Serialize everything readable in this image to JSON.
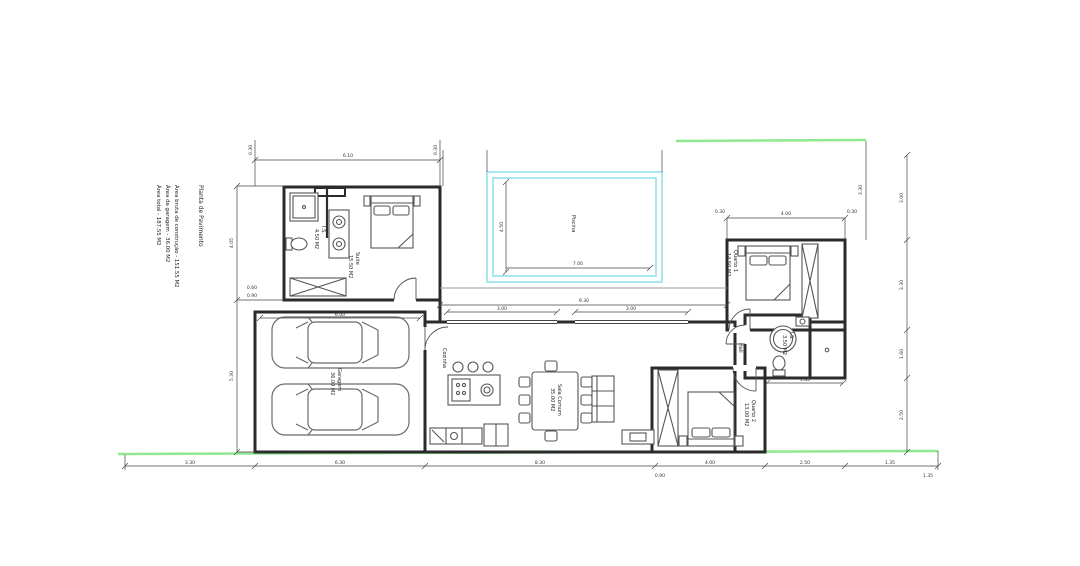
{
  "title_block": {
    "title": "Planta de Pavimento",
    "lines": [
      "Área bruta de construção  - 151.55 M2",
      "Área da garagem  - 36.00 M2",
      "Área total  - 187.55 M2"
    ]
  },
  "rooms": {
    "suite": {
      "name": "Suite",
      "area": "15.50 M2"
    },
    "suite_bath city": {
      "name": "I.S."
    },
    "suite_bath": {
      "name": "I.S.",
      "area": "4.50 M2"
    },
    "pool": {
      "name": "Piscina"
    },
    "garage": {
      "name": "Garagem",
      "area": "36.00 M2"
    },
    "kitchen": {
      "name": "Cozinha"
    },
    "living": {
      "name": "Sala Comum",
      "area": "35.00 M2"
    },
    "hall": {
      "name": "Hall"
    },
    "bedroom1": {
      "name": "Quarto 1",
      "area": "14.50 M2"
    },
    "bath2": {
      "name": "I.S.",
      "area": "3.50 M2"
    },
    "bedroom2": {
      "name": "Quarto 2",
      "area": "13.00 M2"
    }
  },
  "dimensions": {
    "top_left": "6.10",
    "top_left_offsets": [
      "0.30",
      "0.30"
    ],
    "garage_width": "6.00",
    "bedroom1_width": "4.00",
    "bedroom1_offsets": [
      "0.30",
      "0.30"
    ],
    "pool_width": "7.00",
    "pool_height": "4.50",
    "living_front": "9.30",
    "glazing": [
      "3.00",
      "3.00"
    ],
    "corridor": "1.80",
    "left_chain": [
      "4.05",
      "5.30"
    ],
    "right_chain": [
      "3.00",
      "3.30",
      "1.60",
      "2.50"
    ],
    "right_offset": "3.30",
    "bottom_chain": [
      "3.30",
      "6.30",
      "8.30",
      "4.00",
      "2.50",
      "1.35"
    ],
    "bottom_sub": [
      "0.90",
      "1.35"
    ],
    "wardrobe_dims": [
      "0.60",
      "0.90"
    ]
  },
  "colors": {
    "wall": "#2b2b2b",
    "furniture": "#555555",
    "pool_cyan": "#a9e7f0",
    "boundary_green": "#90e890",
    "dimension": "#444444",
    "paper": "#ffffff"
  }
}
